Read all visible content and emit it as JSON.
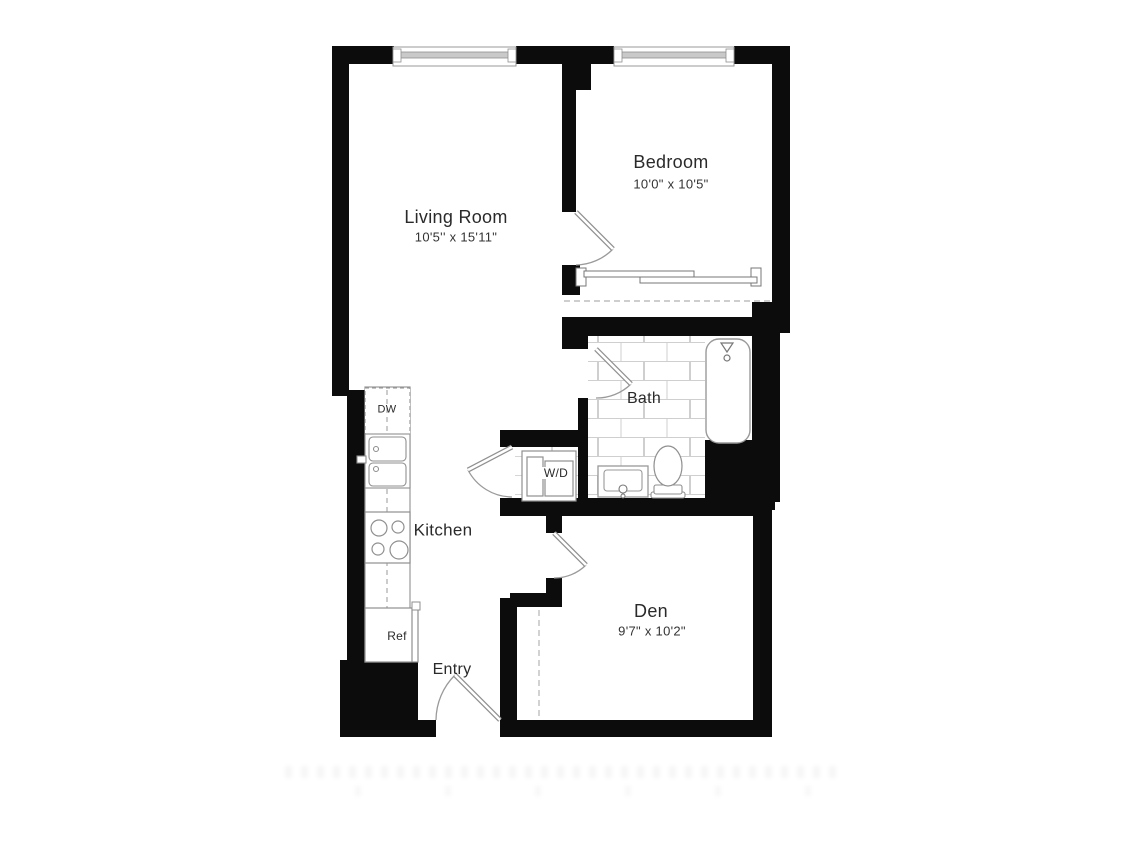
{
  "floorplan": {
    "type": "apartment-floor-plan",
    "rooms": {
      "living_room": {
        "label": "Living Room",
        "dimensions": "10'5'' x 15'11\""
      },
      "bedroom": {
        "label": "Bedroom",
        "dimensions": "10'0\" x 10'5\""
      },
      "bath": {
        "label": "Bath"
      },
      "kitchen": {
        "label": "Kitchen"
      },
      "den": {
        "label": "Den",
        "dimensions": "9'7\" x 10'2\""
      },
      "entry": {
        "label": "Entry"
      }
    },
    "appliances": {
      "dishwasher_label": "DW",
      "washer_dryer_label": "W/D",
      "refrigerator_label": "Ref"
    },
    "fixture_icons": [
      "bathtub-icon",
      "toilet-icon",
      "bathroom-sink-icon",
      "double-kitchen-sink-icon",
      "stove-4-burner-icon",
      "dishwasher-icon",
      "refrigerator-icon",
      "stacked-washer-dryer-icon",
      "hinged-door-icon",
      "sliding-bypass-closet-door-icon",
      "double-window-icon",
      "tub-faucet-icon"
    ],
    "colors": {
      "wall": "#0c0c0c",
      "fixture_outline": "#8f8f8f",
      "tile_line": "#cfcfcf",
      "dashed_line": "#b0b0b0",
      "window_glass": "#c9c9c9",
      "text": "#2a2a2a",
      "background": "#ffffff"
    }
  }
}
